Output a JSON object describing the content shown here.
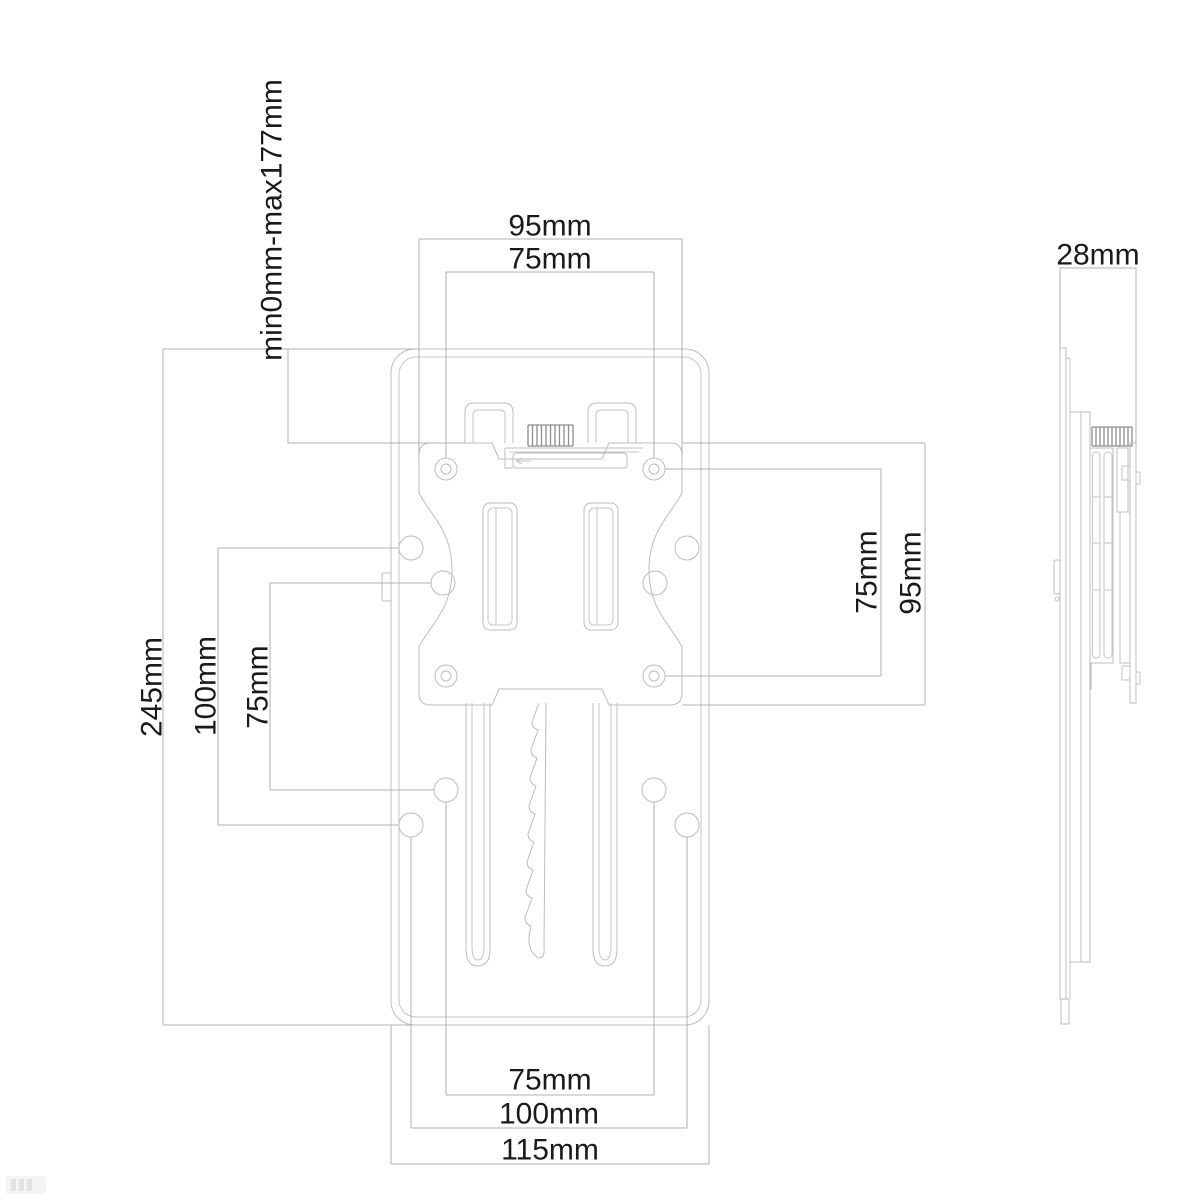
{
  "diagram": {
    "views": {
      "front": {
        "labels": {
          "width_outer": "95mm",
          "width_inner": "75mm",
          "travel_range": "min0mm-max177mm",
          "plate_height": "245mm",
          "hole_spacing_100": "100mm",
          "hole_spacing_75": "75mm",
          "vesa_vertical_75": "75mm",
          "plate_vertical_95": "95mm",
          "bottom_75": "75mm",
          "bottom_100": "100mm",
          "bottom_115": "115mm"
        }
      },
      "side": {
        "labels": {
          "depth": "28mm"
        }
      }
    },
    "colors": {
      "background": "#ffffff",
      "object_line": "#bdbdbd",
      "dimension_line": "#b0b0b0",
      "label_text": "#1a1a1a"
    }
  }
}
